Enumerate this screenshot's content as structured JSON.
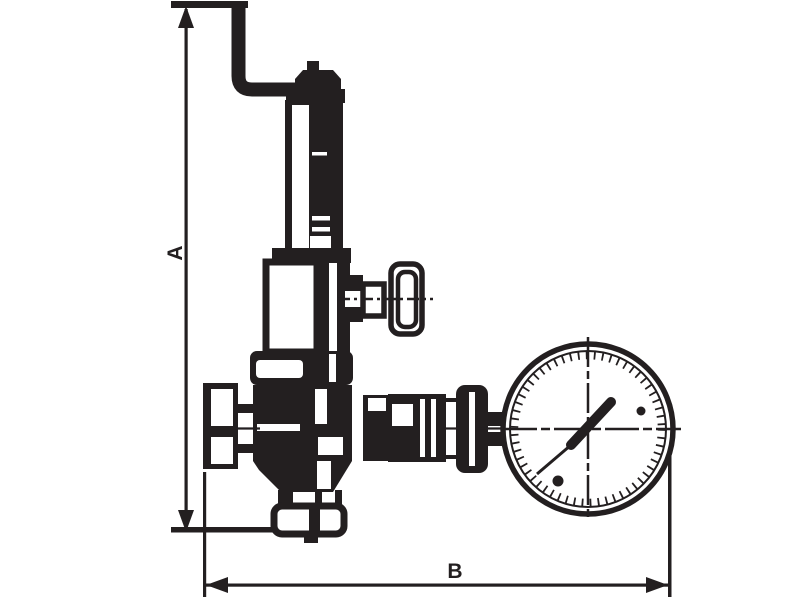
{
  "diagram": {
    "type": "technical-dimension-drawing",
    "subject": "Adjustable pressure relief / reducing valve with lifting lever, spring bonnet, side adjuster knob, bottom outlet flange and attached pressure gauge",
    "background_color": "#ffffff",
    "line_color": "#231f20",
    "dimensions": [
      {
        "id": "A",
        "label": "A",
        "orientation": "vertical",
        "measures": "overall height from outlet base line to top of lever pipe"
      },
      {
        "id": "B",
        "label": "B",
        "orientation": "horizontal",
        "measures": "overall width from inlet flange face to outer edge of pressure gauge"
      }
    ],
    "components": [
      "lever-pipe",
      "bonnet-cap",
      "spring-bonnet-tube",
      "spring-housing",
      "adjuster-boss",
      "adjuster-stem",
      "adjuster-knob",
      "body-top-flange",
      "valve-body",
      "inlet-flange",
      "inlet-neck",
      "outlet-neck",
      "outlet-flange",
      "outlet-tip",
      "gauge-adapter",
      "gauge-union-nut",
      "gauge-hex-nut",
      "gauge-cap-nut",
      "gauge-nipple",
      "pressure-gauge",
      "gauge-needle"
    ]
  }
}
